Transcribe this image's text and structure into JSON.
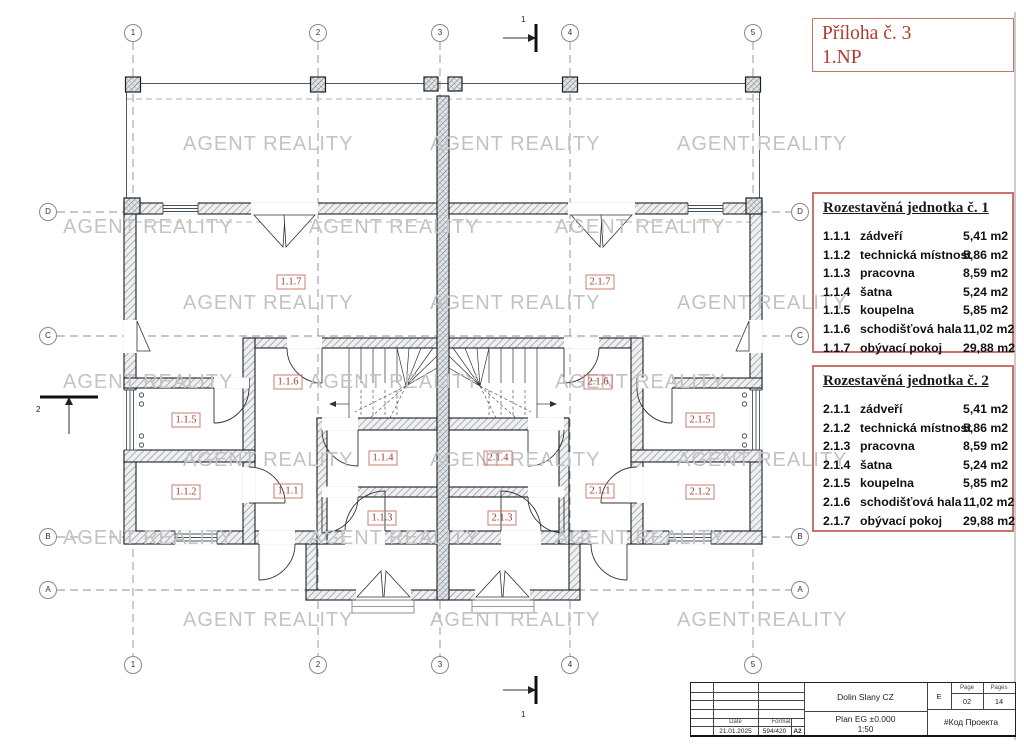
{
  "attachment_note": {
    "line1": "Příloha č. 3",
    "line2": "1.NP"
  },
  "watermark": {
    "text": "AGENT REALITY",
    "color": "#c3c3c3"
  },
  "plan": {
    "grid_columns": [
      "1",
      "2",
      "3",
      "4",
      "5"
    ],
    "grid_rows": [
      "D",
      "C",
      "B",
      "A"
    ],
    "section_marker_1": "1",
    "section_marker_2": "2",
    "room_labels": {
      "u1_7": "1.1.7",
      "u2_7": "2.1.7",
      "u1_6": "1.1.6",
      "u2_6": "2.1.6",
      "u1_5": "1.1.5",
      "u2_5": "2.1.5",
      "u1_4": "1.1.4",
      "u2_4": "2.1.4",
      "u1_1": "1.1.1",
      "u2_1": "2.1.1",
      "u1_2": "1.1.2",
      "u2_2": "2.1.2",
      "u1_3": "1.1.3",
      "u2_3": "2.1.3"
    }
  },
  "units": [
    {
      "title": "Rozestavěná jednotka č. 1",
      "rooms": [
        {
          "code": "1.1.1",
          "name": "zádveří",
          "area": "5,41 m2"
        },
        {
          "code": "1.1.2",
          "name": "technická místnost",
          "area": "5,86 m2"
        },
        {
          "code": "1.1.3",
          "name": "pracovna",
          "area": "8,59 m2"
        },
        {
          "code": "1.1.4",
          "name": "šatna",
          "area": "5,24 m2"
        },
        {
          "code": "1.1.5",
          "name": "koupelna",
          "area": "5,85 m2"
        },
        {
          "code": "1.1.6",
          "name": "schodišťová hala",
          "area": "11,02 m2"
        },
        {
          "code": "1.1.7",
          "name": "obývací pokoj",
          "area": "29,88 m2"
        }
      ]
    },
    {
      "title": "Rozestavěná jednotka č. 2",
      "rooms": [
        {
          "code": "2.1.1",
          "name": "zádveří",
          "area": "5,41 m2"
        },
        {
          "code": "2.1.2",
          "name": "technická místnost",
          "area": "5,86 m2"
        },
        {
          "code": "2.1.3",
          "name": "pracovna",
          "area": "8,59 m2"
        },
        {
          "code": "2.1.4",
          "name": "šatna",
          "area": "5,24 m2"
        },
        {
          "code": "2.1.5",
          "name": "koupelna",
          "area": "5,85 m2"
        },
        {
          "code": "2.1.6",
          "name": "schodišťová hala",
          "area": "11,02 m2"
        },
        {
          "code": "2.1.7",
          "name": "obývací pokoj",
          "area": "29,88 m2"
        }
      ]
    }
  ],
  "title_block": {
    "project": "Dolin Slany CZ",
    "drawing": "Plan EG ±0.000",
    "scale": "1:50",
    "page_label": "Page",
    "pages_label": "Pages",
    "revision": "E",
    "page": "02",
    "pages": "14",
    "project_code": "#Код Проекта",
    "date_label": "Date",
    "date": "21.01.2025",
    "format": "594/420",
    "format_label": "Format",
    "format_size": "A2"
  }
}
